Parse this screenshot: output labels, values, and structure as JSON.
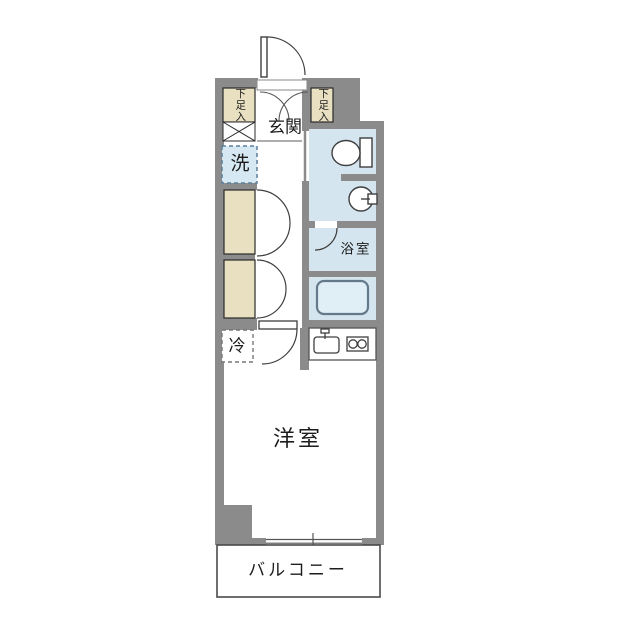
{
  "floor_plan": {
    "type": "apartment-floor-plan-1K",
    "rooms": {
      "genkan": {
        "label": "玄関"
      },
      "shoe_left": {
        "label": "下足入"
      },
      "shoe_right": {
        "label": "下足入"
      },
      "washer": {
        "label": "洗"
      },
      "bathroom": {
        "label": "浴室"
      },
      "fridge": {
        "label": "冷"
      },
      "western_room": {
        "label": "洋室"
      },
      "balcony": {
        "label": "バルコニー"
      }
    },
    "fixtures": [
      "entrance-door",
      "shoe-cabinet-doors",
      "toilet",
      "washbasin",
      "bathtub",
      "kitchen-sink",
      "two-burner-stove",
      "closet-double-doors",
      "room-door",
      "sliding-window"
    ],
    "colors": {
      "wall": "#8b8b8b",
      "water_room": "#d4e5ef",
      "storage_box": "#e8e0c1",
      "washer_fill": "#d6e8f1",
      "washer_border": "#5d7f9a",
      "tub_fill": "#e0eef5",
      "tub_stroke": "#64798a",
      "fixture_line": "#3f3f3f",
      "balcony_border": "#4a4a4a",
      "text": "#1c1c1c"
    }
  }
}
